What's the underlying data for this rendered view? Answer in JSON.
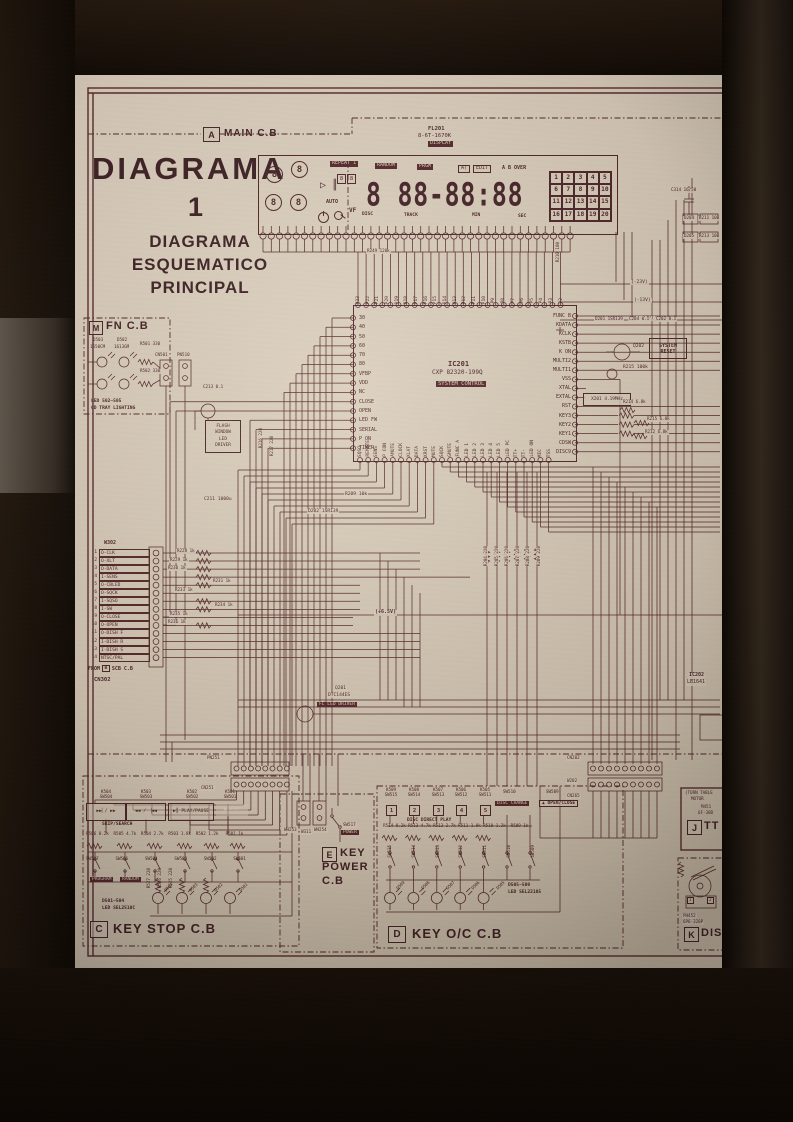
{
  "header": {
    "tag": "A",
    "title": "MAIN C.B"
  },
  "title": {
    "main": "DIAGRAMA",
    "number": "1",
    "subtitle": [
      "DIAGRAMA",
      "ESQUEMATICO",
      "PRINCIPAL"
    ]
  },
  "display": {
    "ref": "FL201",
    "part": "8-6T-1670K",
    "name": "DISPLAY",
    "indicators": [
      "REPEAT 1",
      "RANDOM",
      "PRGM",
      "A)",
      "EDIT",
      "A B OVER"
    ],
    "dials": [
      "8",
      "8",
      "8",
      "8"
    ],
    "mini_digits": [
      "8",
      "8"
    ],
    "auto": "AUTO",
    "vf": "VF",
    "digits": "8 88-88:88",
    "units": [
      "DISC",
      "TRACK",
      "MIN",
      "SEC"
    ],
    "grid": [
      "1",
      "2",
      "3",
      "4",
      "5",
      "6",
      "7",
      "8",
      "9",
      "10",
      "11",
      "12",
      "13",
      "14",
      "15",
      "16",
      "17",
      "18",
      "19",
      "20"
    ],
    "r249": "R249 120k",
    "r210": "R210 100"
  },
  "ic201": {
    "ref": "IC201",
    "part": "CXP 82320-199Q",
    "func": "SYSTEM CONTROL",
    "left_pins": [
      "30",
      "40",
      "50",
      "60",
      "70",
      "80",
      "VFBP",
      "VDD",
      "NC",
      "CLOSE",
      "OPEN",
      "LED FW",
      "SERIAL",
      "P ON",
      "TIMER"
    ],
    "right_pins": [
      "FUNC B",
      "KDATA",
      "KCLK",
      "KSTB",
      "K ON",
      "MULTI2",
      "MULTI1",
      "VSS",
      "XTAL",
      "EXTAL",
      "RST",
      "KEY3",
      "KEY2",
      "KEY1",
      "CDSW",
      "DISC9"
    ],
    "top_pins": [
      "P23",
      "P22",
      "P21",
      "P20",
      "P19",
      "P18",
      "P17",
      "P16",
      "P15",
      "P14",
      "P13",
      "P12",
      "P11",
      "P10",
      "P9",
      "P8",
      "P7",
      "P6",
      "P5",
      "P4",
      "P3",
      "P2"
    ],
    "bottom_pins": [
      "SQSO",
      "REMOTE",
      "SENS",
      "P CON",
      "AMUTE",
      "CLOCK",
      "XLAT",
      "DATA",
      "XRST",
      "MUTE",
      "SQCK",
      "GMUTE",
      "FUNC A",
      "LED 1",
      "LED 2",
      "LED 3",
      "LED 4",
      "LED 5",
      "LED PC",
      "TT+",
      "TT-",
      "LED ON",
      "MIC",
      "TSS"
    ]
  },
  "fn": {
    "tag": "M",
    "title": "FN C.B",
    "d1": "D503",
    "d2": "D502",
    "p1": "1550CM",
    "p2": "1613GM",
    "r1": "R501 330",
    "r2": "R502 330",
    "note1": "LED 502~505",
    "note2": "CD TRAY LIGHTING",
    "cn": "CN501",
    "pn": "PN510",
    "cap": "C213 0.1"
  },
  "flash": {
    "lines": [
      "FLASH",
      "WINDOW",
      "LED",
      "DRIVER"
    ]
  },
  "cn302": {
    "header": "W302",
    "rows": [
      [
        "1",
        "O-CLK"
      ],
      [
        "2",
        "O-XLT"
      ],
      [
        "3",
        "O-DATA"
      ],
      [
        "4",
        "I-SENS"
      ],
      [
        "5",
        "O-CBLED"
      ],
      [
        "6",
        "O-SQCK"
      ],
      [
        "7",
        "I-SQSO"
      ],
      [
        "8",
        "I-SW"
      ],
      [
        "9",
        "O-CLOSE"
      ],
      [
        "10",
        "O-OPEN"
      ],
      [
        "11",
        "O-DISH F"
      ],
      [
        "12",
        "I-DISH R"
      ],
      [
        "13",
        "I-DISH S"
      ],
      [
        "14",
        "NTSC/PAL"
      ]
    ],
    "resistors": [
      "R228 1k",
      "R229 1k",
      "R230 1k",
      "R231 1k",
      "R233 1k",
      "R234 1k",
      "R235 1k",
      "R236 1k"
    ],
    "from_word": "FROM",
    "from_tag": "B",
    "from_board": "SCB C.B",
    "conn": "CN302"
  },
  "mid": {
    "r220": [
      "R204 220",
      "R205 220",
      "R206 220",
      "R207 220",
      "R208 220",
      "R209 220"
    ],
    "v65": "(+6.5V)",
    "c211": "C211 1000u",
    "r209": "R209 10k",
    "d202": "D202 1SR139",
    "r216": "R216 220",
    "r217": "R217 220",
    "q201_ref": "Q201",
    "q201_part": "DTC144ES",
    "q201_func": "FL LED DRIVER"
  },
  "right": {
    "c314": "C314 16/50",
    "volts": [
      "(-23V)",
      "(-13V)",
      "(-27V)"
    ],
    "d201": "D201 1SR139",
    "c204": "C204 0.1",
    "c202": "C202 0.1",
    "q202": "Q202",
    "r215": "R215 100k",
    "reset": [
      "SYSTEM",
      "RESET"
    ],
    "x201": "X201 4.19MHz",
    "r214": "R214 6.8k",
    "r215b": "R215 6.8k",
    "r212": "R212 6.8k",
    "d204": "D204",
    "r211": "R211 100",
    "d205": "D205",
    "r213": "R213 100",
    "ic202_ref": "IC202",
    "ic202_part": "LB1641"
  },
  "cn202": {
    "a": "CN202",
    "b": "W202",
    "c": "CN265"
  },
  "key_stop": {
    "tag": "C",
    "title": "KEY STOP C.B",
    "pn": "PN251",
    "cn": "CN251",
    "buttons": [
      {
        "ref": "K504",
        "sw": "SW504",
        "label": "▶▶▏/ ▶▶"
      },
      {
        "ref": "K503",
        "sw": "SW503",
        "label": "◀◀ / ▕◀◀"
      },
      {
        "ref": "K502",
        "sw": "SW502",
        "label": "▶║ PLAY/PAUSE"
      },
      {
        "ref": "K501",
        "sw": "SW501",
        "label": "■ STOP"
      }
    ],
    "skip": "SKIP/SEARCH",
    "resistors": [
      "R506 8.2k",
      "R505 4.7k",
      "R504 2.7k",
      "R503 1.8k",
      "R502 1.2k",
      "R501 1k"
    ],
    "switches": [
      "SW507",
      "SW506",
      "SW504",
      "SW503",
      "SW502",
      "SW501"
    ],
    "sw507": "PROGRAM",
    "sw506": "RANDOM",
    "led_res": [
      "R527 220",
      "R526 220",
      "R525 220"
    ],
    "leds": [
      "D504",
      "D503",
      "D502",
      "D501"
    ],
    "note1": "D501~504",
    "note2": "LED SEL2510C"
  },
  "key_power": {
    "tag": "E",
    "title": [
      "KEY",
      "POWER",
      "C.B"
    ],
    "wh1": "WH253",
    "w": "W311",
    "wh2": "WH254",
    "sw": "SW517",
    "sw_label": "POWER"
  },
  "key_oc": {
    "tag": "D",
    "title": "KEY O/C C.B",
    "buttons": [
      {
        "ref": "K509",
        "sw": "SW515",
        "num": "1"
      },
      {
        "ref": "K508",
        "sw": "SW514",
        "num": "2"
      },
      {
        "ref": "K507",
        "sw": "SW513",
        "num": "3"
      },
      {
        "ref": "K506",
        "sw": "SW512",
        "num": "4"
      },
      {
        "ref": "K505",
        "sw": "SW511",
        "num": "5"
      }
    ],
    "direct": "DISC DIRECT PLAY",
    "sw510_ref": "SW510",
    "sw510": "DISC CHANGE",
    "sw509_ref": "SW509",
    "sw509": "▲ OPEN/CLOSE",
    "resistors": [
      "R514 8.2k",
      "R513 4.7k",
      "R512 2.7k",
      "R511 1.8k",
      "R510 1.2k",
      "R509 1k"
    ],
    "switches": [
      "SW515",
      "SW514",
      "SW513",
      "SW512",
      "SW511",
      "SW510",
      "SW509"
    ],
    "leds": [
      "D509",
      "D508",
      "D507",
      "D506",
      "D505"
    ],
    "note1": "D505~509",
    "note2": "LED SEL22105"
  },
  "tt": {
    "tag": "J",
    "title": "TT",
    "note1": "(TURN TABLE",
    "note2": "MOTOR",
    "part1": "M451",
    "part2": "6F-38D"
  },
  "dis": {
    "tag": "K",
    "title": "DIS",
    "part1": "PH452",
    "part2": "6P6-320P",
    "pins": [
      "1",
      "2"
    ]
  },
  "icons": {
    "play-icon": "▷",
    "pause-icon": "║"
  }
}
